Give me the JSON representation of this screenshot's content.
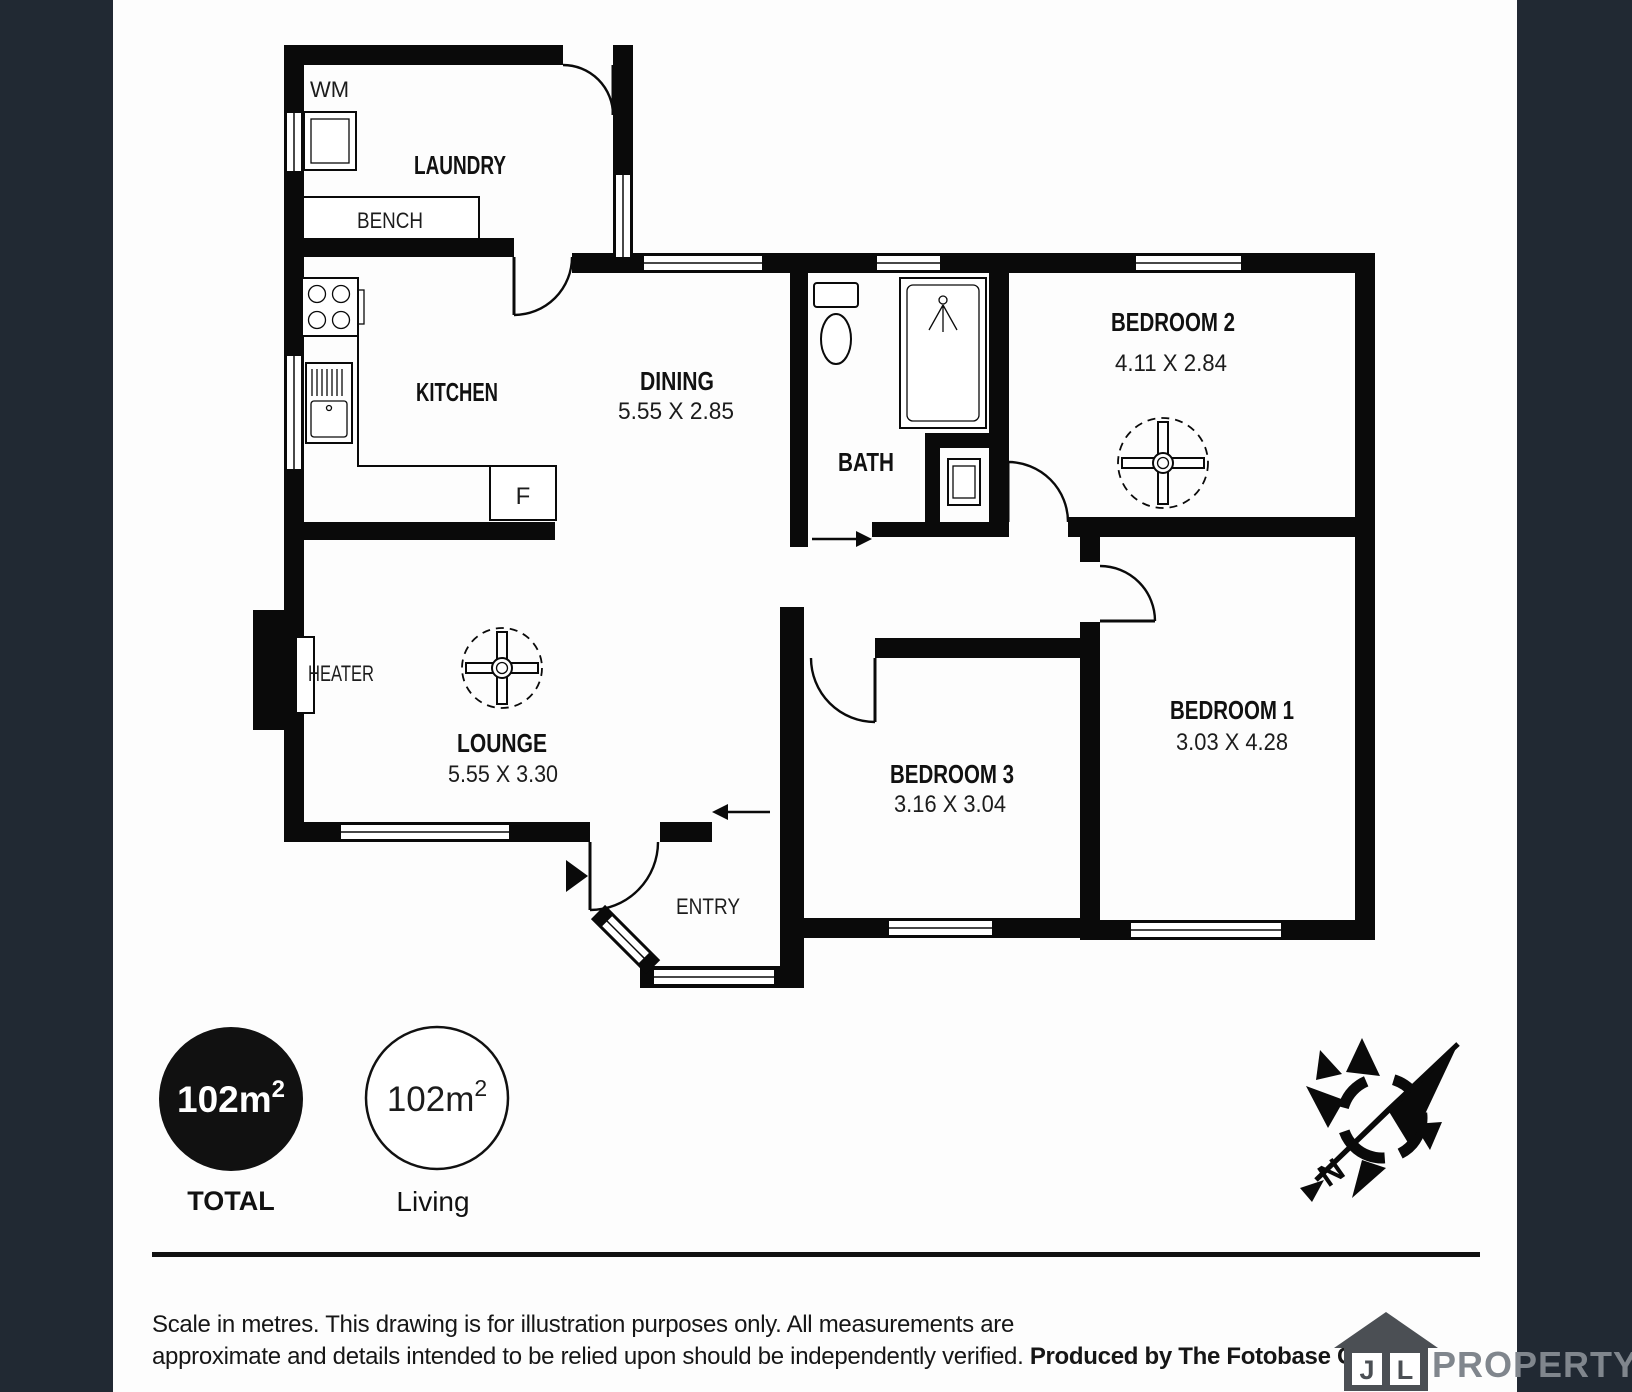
{
  "rooms": {
    "laundry": {
      "label": "LAUNDRY"
    },
    "kitchen": {
      "label": "KITCHEN"
    },
    "dining": {
      "label": "DINING",
      "dims": "5.55 X 2.85"
    },
    "bath": {
      "label": "BATH"
    },
    "bedroom2": {
      "label": "BEDROOM 2",
      "dims": "4.11 X 2.84"
    },
    "lounge": {
      "label": "LOUNGE",
      "dims": "5.55 X 3.30"
    },
    "bedroom3": {
      "label": "BEDROOM 3",
      "dims": "3.16 X 3.04"
    },
    "bedroom1": {
      "label": "BEDROOM 1",
      "dims": "3.03 X 4.28"
    },
    "entry": {
      "label": "ENTRY"
    }
  },
  "fixtures": {
    "washing_machine": "WM",
    "bench": "BENCH",
    "fridge": "F",
    "heater": "HEATER"
  },
  "badges": {
    "total": {
      "value": "102m",
      "sup": "2",
      "label": "TOTAL"
    },
    "living": {
      "value": "102m",
      "sup": "2",
      "label": "Living"
    }
  },
  "compass": {
    "north": "N"
  },
  "footer": {
    "disclaimer_line1": "Scale in metres. This drawing is for illustration purposes only. All measurements are",
    "disclaimer_line2": "approximate and details intended to be relied upon should be independently verified. ",
    "producer": "Produced by The Fotobase Group"
  },
  "brand": {
    "letter1": "J",
    "letter2": "L",
    "name": "PROPERTY"
  },
  "colors": {
    "sidebar": "#212933",
    "walls": "#0a0a0a",
    "brand_gray": "#80868d"
  }
}
